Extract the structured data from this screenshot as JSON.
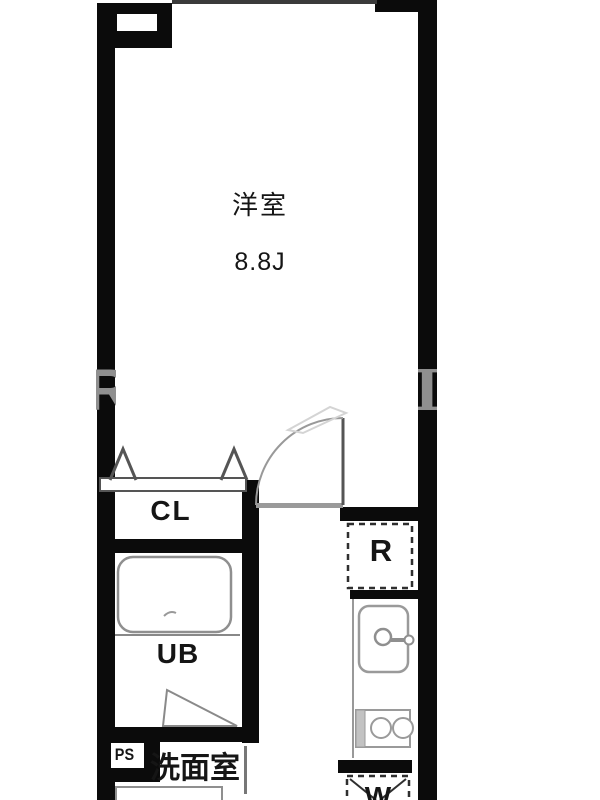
{
  "floor_plan": {
    "western_room": {
      "label": "洋室",
      "area": "8.8J"
    },
    "closet": {
      "label": "CL"
    },
    "unit_bath": {
      "label": "UB"
    },
    "pipe_space": {
      "label": "PS"
    },
    "washroom": {
      "label": "洗面室"
    },
    "refrigerator_space": {
      "label": "R"
    },
    "washer_space": {
      "label": "W"
    },
    "watermark": {
      "left": "R",
      "right": "I"
    },
    "colors": {
      "wall": "#0b0b0b",
      "fixture_outline": "#8f8f8f",
      "door_line": "#999999",
      "dashed_appliance": "#2f2f2f",
      "watermark_gray": "#8f8f8f"
    }
  }
}
